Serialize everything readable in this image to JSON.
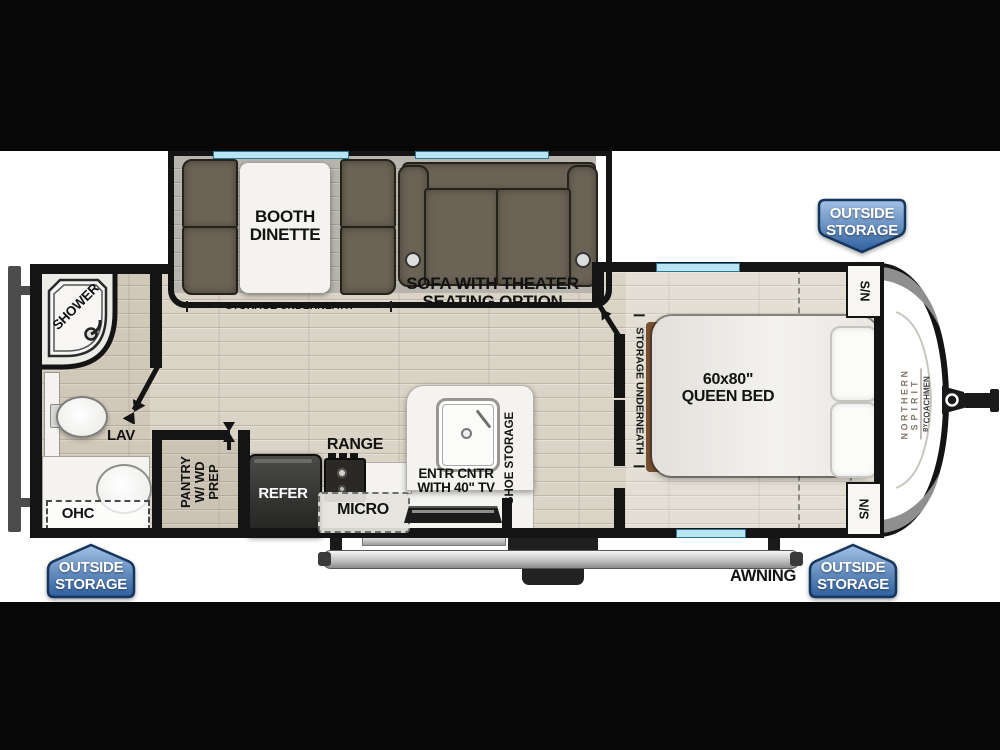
{
  "scene": {
    "kind": "travel-trailer-floorplan"
  },
  "labels": {
    "booth_dinette": {
      "line1": "BOOTH",
      "line2": "DINETTE"
    },
    "storage_underneath": "STORAGE UNDERNEATH",
    "sofa": {
      "line1": "SOFA WITH THEATER",
      "line2": "SEATING OPTION"
    },
    "shower": "SHOWER",
    "lav": "LAV",
    "ohc": "OHC",
    "pantry": {
      "line1": "PANTRY",
      "line2": "W/ WD",
      "line3": "PREP"
    },
    "refer": "REFER",
    "range": "RANGE",
    "micro": "MICRO",
    "entr": {
      "line1": "ENTR CNTR",
      "line2": "WITH 40\" TV"
    },
    "shoe_storage": "SHOE STORAGE",
    "bed": {
      "line1": "60x80\"",
      "line2": "QUEEN BED"
    },
    "nightstand": "S/N",
    "awning": "AWNING"
  },
  "badges": {
    "outside_storage": {
      "line1": "OUTSIDE",
      "line2": "STORAGE"
    }
  },
  "brand": {
    "line1": "NORTHERN",
    "line2": "SPIRIT",
    "by": "BY",
    "coachmen": "COACHMEN"
  },
  "colors": {
    "wall": "#141414",
    "window_blue": "#b8e4f4",
    "floor_wood": "#dad4c6",
    "slide_floor": "#b7b4ae",
    "cushion_brown": "#6b6355",
    "badge_blue_top": "#93b7e0",
    "badge_blue_bottom": "#2e5f9e"
  }
}
